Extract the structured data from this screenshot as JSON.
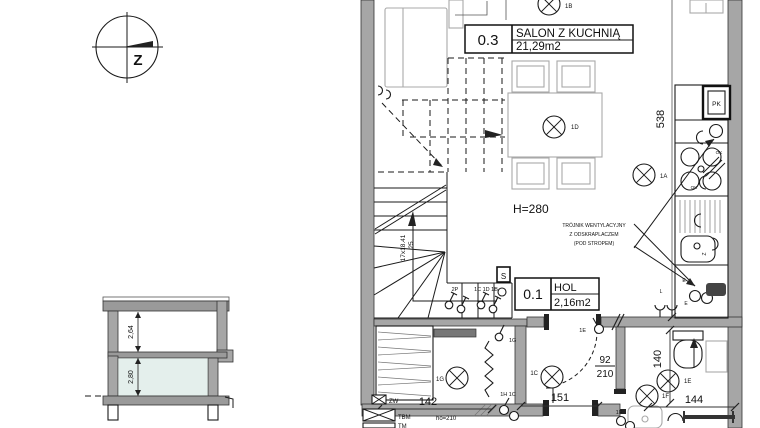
{
  "compass": {
    "label": "Z"
  },
  "section": {
    "upper_height": "2,64",
    "lower_height": "2,80"
  },
  "plan": {
    "rooms": [
      {
        "code": "0.3",
        "name": "SALON Z KUCHNIĄ",
        "area": "21,29m2"
      },
      {
        "code": "0.1",
        "name": "HOL",
        "area": "2,16m2"
      }
    ],
    "ceiling_height": "H=280",
    "vent_note": [
      "TRÓJNIK WENTYLACYJNY",
      "Z ODSKRAPLACZEM",
      "(POD STROPEM)"
    ],
    "stairs": {
      "steps": "17x18.41",
      "width": "25"
    },
    "door": {
      "width": "92",
      "height": "210"
    },
    "dims": {
      "d538": "538",
      "d142": "142",
      "d151": "151",
      "d144": "144",
      "d140": "140"
    },
    "lights": {
      "a": "1A",
      "b": "1B",
      "c": "1C",
      "d": "1D",
      "e": "1E",
      "f": "1F",
      "g": "1G"
    },
    "switches": {
      "s1": "2P",
      "s2": "1C 1D 1B",
      "s3": "1G",
      "s4": "1E",
      "s5": "1H 1C",
      "s6": "1F"
    },
    "sockets": {
      "l": "L",
      "e1": "E",
      "e2": "E",
      "ok1": "OK",
      "ok2": "OK",
      "z": "Z"
    },
    "boxes": {
      "pk": "PK",
      "zw": "ZW",
      "tbm": "TBM",
      "tm": "TM",
      "s": "S",
      "ho": "ho=210"
    }
  }
}
